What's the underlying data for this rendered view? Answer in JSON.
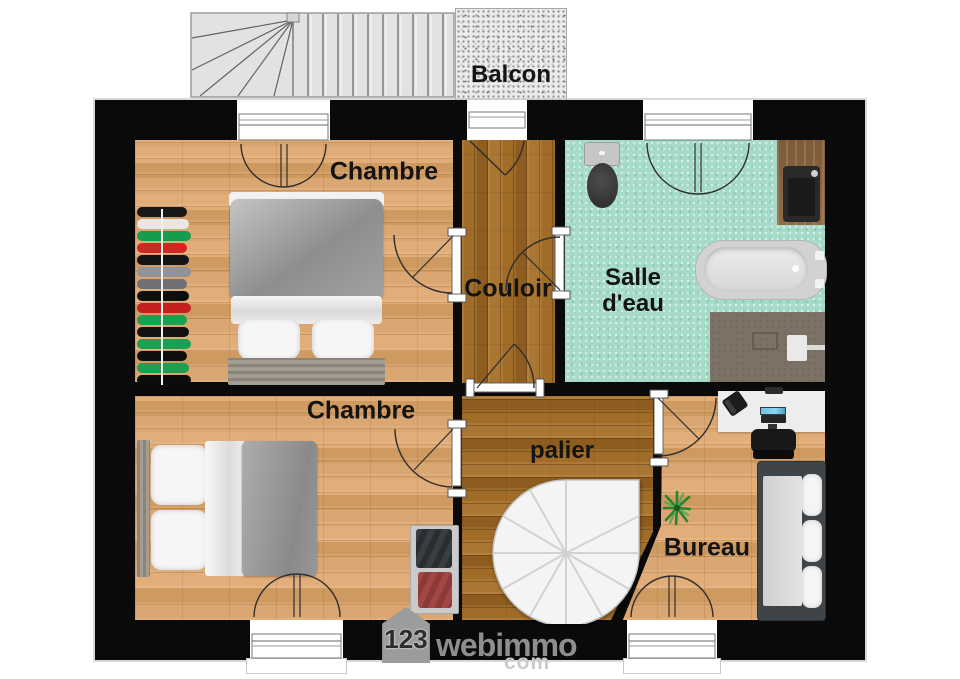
{
  "plan": {
    "exterior": {
      "balcony_label": "Balcon"
    },
    "rooms": {
      "chambre_top": {
        "label": "Chambre",
        "floor": "light-wood"
      },
      "chambre_bottom": {
        "label": "Chambre",
        "floor": "light-wood"
      },
      "couloir": {
        "label": "Couloir",
        "floor": "dark-wood"
      },
      "salle_deau": {
        "label": "Salle d'eau",
        "floor": "teal-tile"
      },
      "palier": {
        "label": "palier",
        "floor": "dark-wood"
      },
      "bureau": {
        "label": "Bureau",
        "floor": "light-wood"
      }
    },
    "furniture": {
      "chambre_top": [
        "clothes-rack",
        "double-bed"
      ],
      "chambre_bottom": [
        "double-bed",
        "storage-shelf"
      ],
      "salle_deau": [
        "toilet",
        "washbasin-vanity",
        "bathtub",
        "shower"
      ],
      "palier": [
        "spiral-staircase"
      ],
      "bureau": [
        "desk",
        "desk-phone",
        "computer-monitor",
        "office-chair",
        "sofa",
        "plant"
      ],
      "clothes_rack_colors": [
        "#181818",
        "#e7e7e5",
        "#169c4e",
        "#d02723",
        "#141414",
        "#90939a",
        "#6e7076",
        "#0e0e0e",
        "#c42020",
        "#18a24f",
        "#121212",
        "#1aa053",
        "#0f0f0f",
        "#1d9e50",
        "#0c0c0c"
      ]
    },
    "palette": {
      "wall": "#0a0a0a",
      "light_wood": "#d6a26e",
      "dark_wood": "#9a662a",
      "bathroom_tile": "#a5dbc8",
      "label_text": "#141414",
      "watermark_grey": "#8e8e8e"
    }
  },
  "watermark": {
    "number": "123",
    "brand": "webimmo",
    "suffix": "com"
  }
}
